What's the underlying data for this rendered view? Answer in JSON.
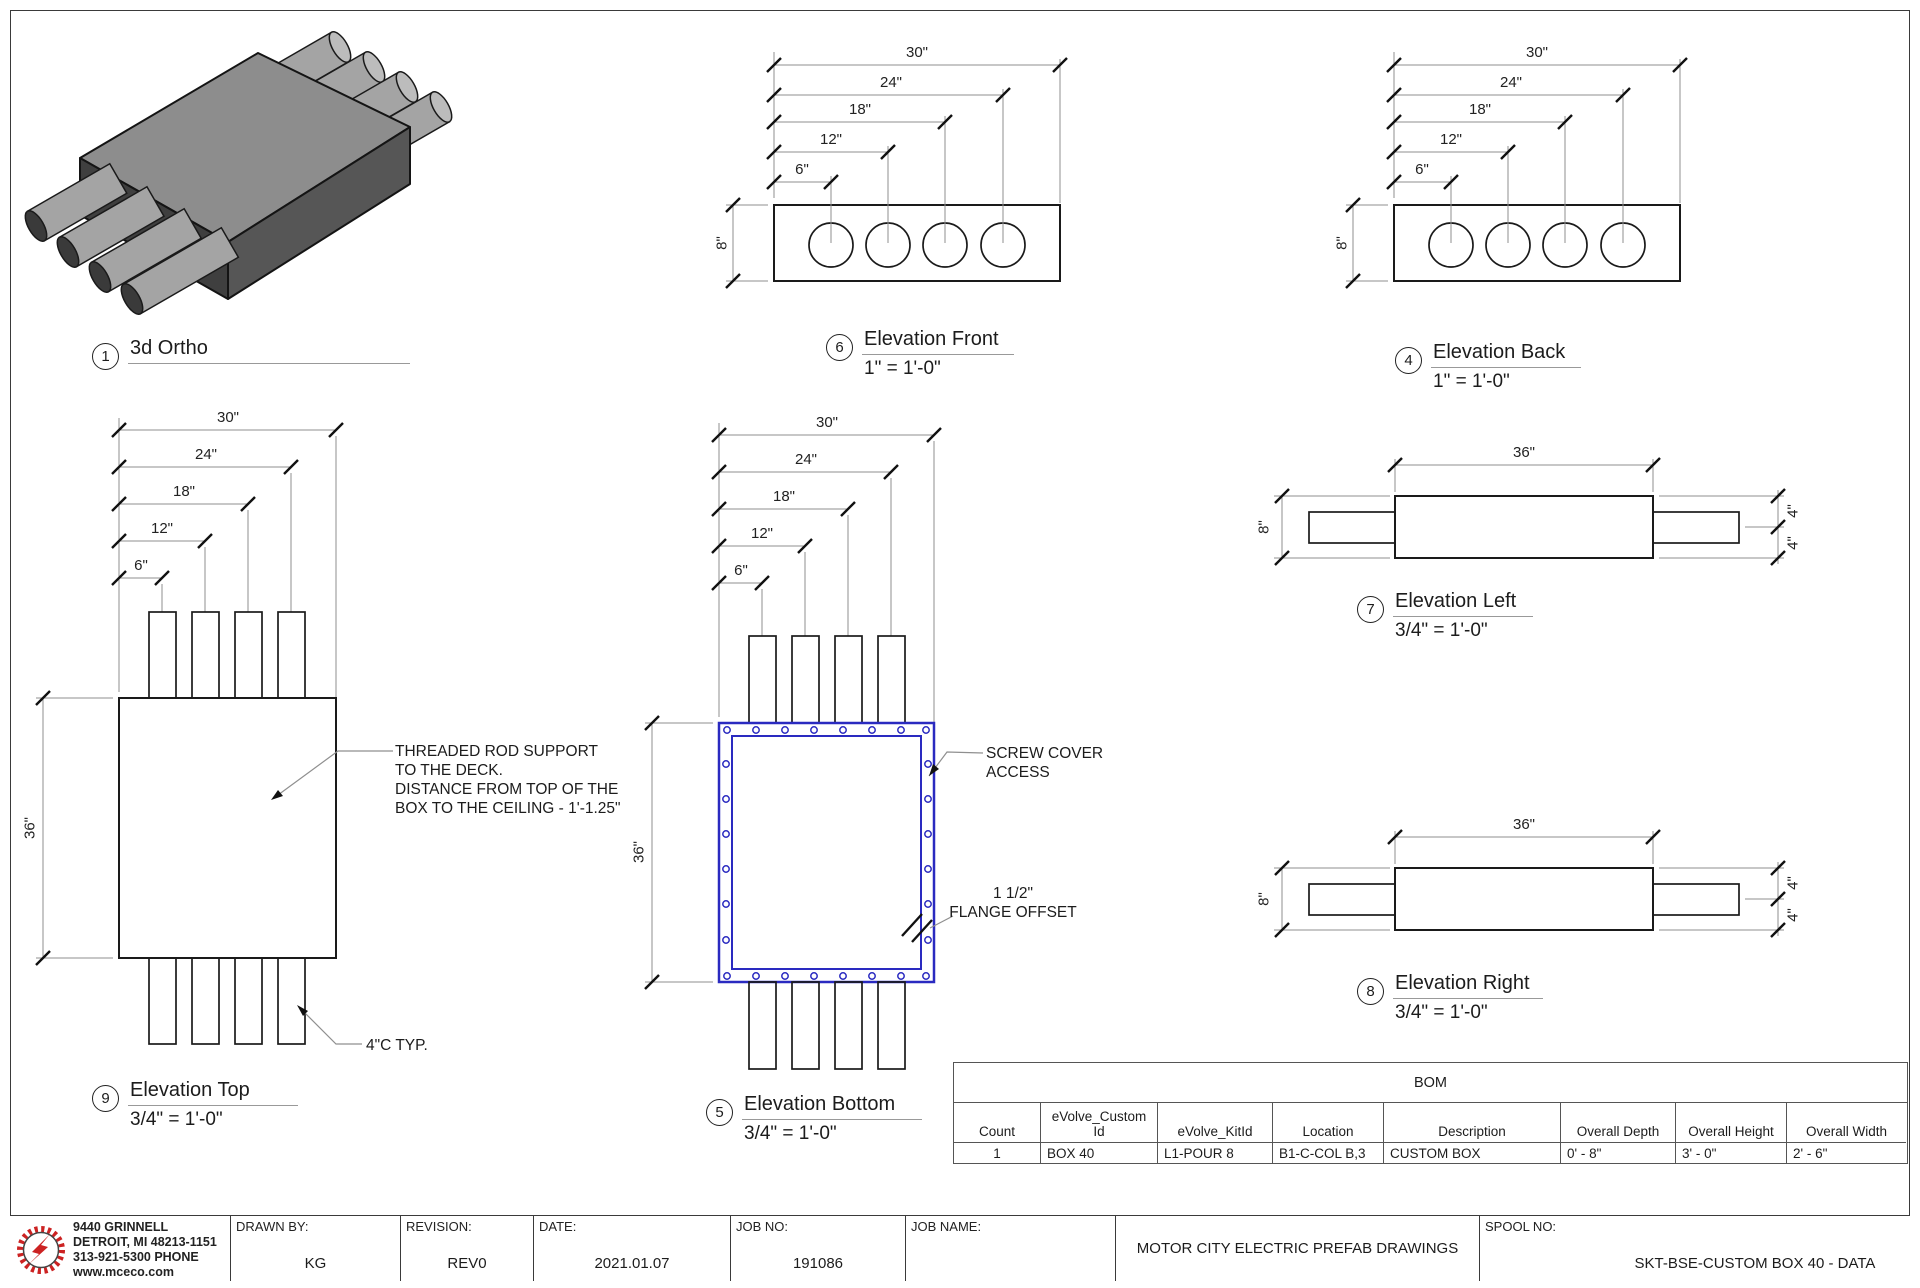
{
  "views": {
    "ortho": {
      "num": "1",
      "title": "3d Ortho"
    },
    "front": {
      "num": "6",
      "title": "Elevation Front",
      "scale": "1\" = 1'-0\"",
      "dims": [
        "6\"",
        "12\"",
        "18\"",
        "24\"",
        "30\""
      ],
      "height": "8\""
    },
    "back": {
      "num": "4",
      "title": "Elevation Back",
      "scale": "1\" = 1'-0\"",
      "dims": [
        "6\"",
        "12\"",
        "18\"",
        "24\"",
        "30\""
      ],
      "height": "8\""
    },
    "top": {
      "num": "9",
      "title": "Elevation Top",
      "scale": "3/4\" = 1'-0\"",
      "dims": [
        "6\"",
        "12\"",
        "18\"",
        "24\"",
        "30\""
      ],
      "depth": "36\"",
      "note_rod": "THREADED ROD SUPPORT\nTO THE DECK.\nDISTANCE FROM TOP OF THE\nBOX TO THE CEILING - 1'-1.25\"",
      "note_conduit": "4\"C TYP."
    },
    "bottom": {
      "num": "5",
      "title": "Elevation Bottom",
      "scale": "3/4\" = 1'-0\"",
      "dims": [
        "6\"",
        "12\"",
        "18\"",
        "24\"",
        "30\""
      ],
      "depth": "36\"",
      "note_screw": "SCREW COVER\nACCESS",
      "note_flange": "1 1/2\"\nFLANGE OFFSET"
    },
    "left": {
      "num": "7",
      "title": "Elevation Left",
      "scale": "3/4\" = 1'-0\"",
      "length": "36\"",
      "height": "8\"",
      "stub": "4\""
    },
    "right": {
      "num": "8",
      "title": "Elevation Right",
      "scale": "3/4\" = 1'-0\"",
      "length": "36\"",
      "height": "8\"",
      "stub": "4\""
    }
  },
  "bom": {
    "title": "BOM",
    "columns": [
      "Count",
      "eVolve_Custom\nId",
      "eVolve_KitId",
      "Location",
      "Description",
      "Overall Depth",
      "Overall Height",
      "Overall Width"
    ],
    "row": [
      "1",
      "BOX 40",
      "L1-POUR 8",
      "B1-C-COL B,3",
      "CUSTOM BOX",
      "0' - 8\"",
      "3' - 0\"",
      "2' - 6\""
    ]
  },
  "titleblock": {
    "address": "9440 GRINNELL\nDETROIT, MI 48213-1151\n313-921-5300 PHONE\nwww.mceco.com",
    "drawn_by": {
      "label": "DRAWN BY:",
      "value": "KG"
    },
    "revision": {
      "label": "REVISION:",
      "value": "REV0"
    },
    "date": {
      "label": "DATE:",
      "value": "2021.01.07"
    },
    "job_no": {
      "label": "JOB NO:",
      "value": "191086"
    },
    "job_name": {
      "label": "JOB NAME:"
    },
    "company": "MOTOR CITY ELECTRIC PREFAB DRAWINGS",
    "spool": {
      "label": "SPOOL NO:",
      "value": "SKT-BSE-CUSTOM BOX 40 - DATA"
    }
  },
  "colors": {
    "accent_blue": "#2a2ac0",
    "logo_red": "#cc2222"
  }
}
